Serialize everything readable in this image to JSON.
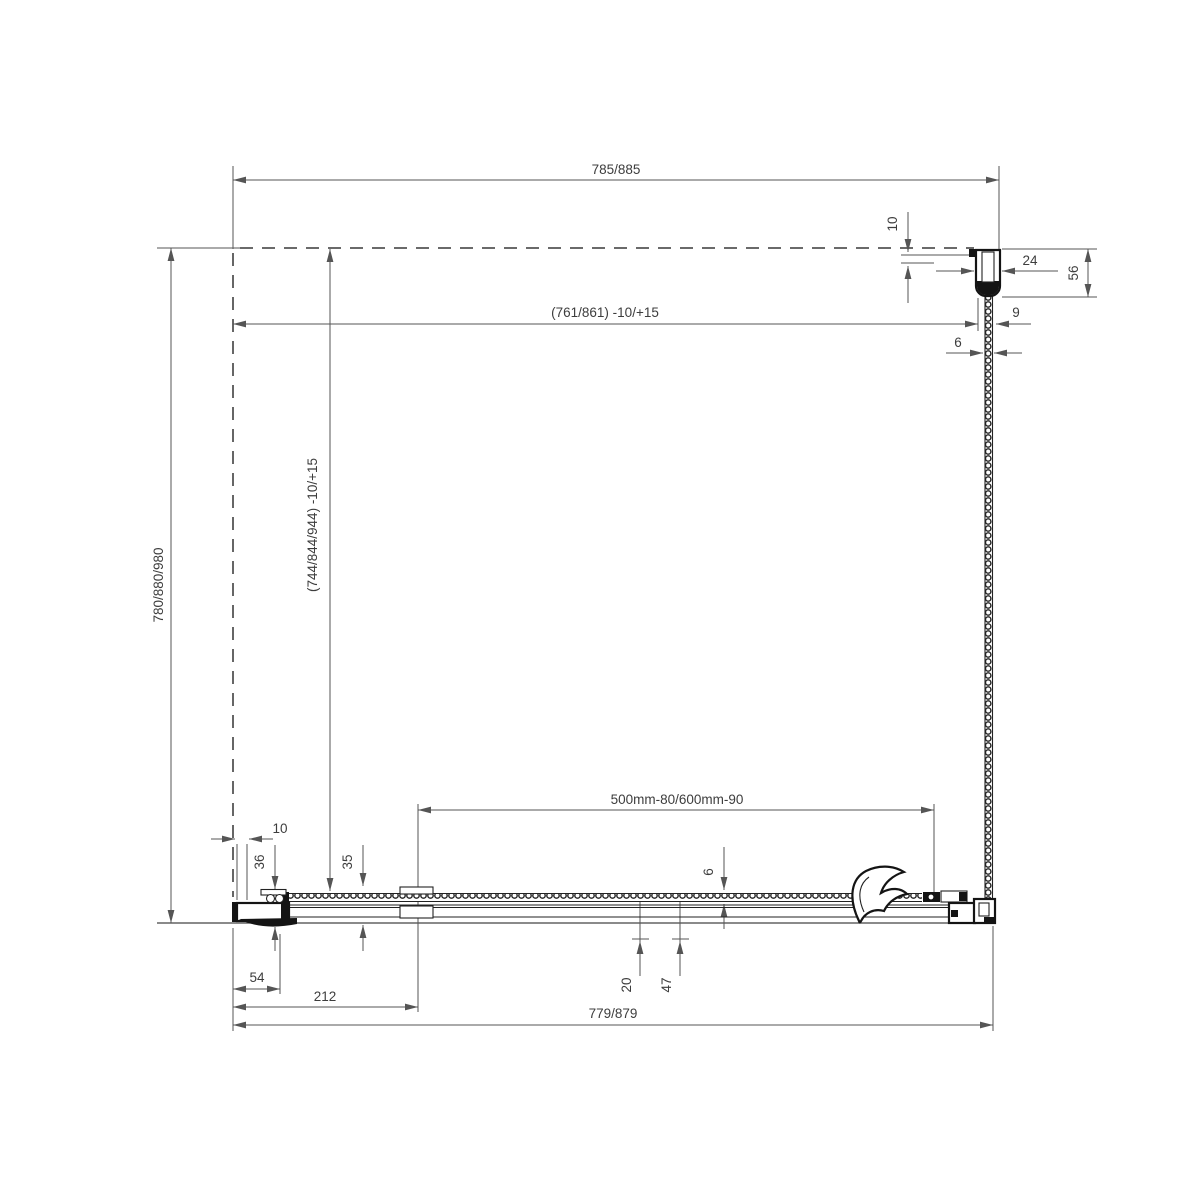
{
  "drawing": {
    "type": "technical-dimension-drawing",
    "subject": "shower-enclosure-plan-view",
    "colors": {
      "line": "#141414",
      "dimension": "#555555",
      "background": "#ffffff"
    },
    "dims": {
      "top_width": "785/885",
      "top_width_adjust": "(761/861) -10/+15",
      "side_depth": "780/880/980",
      "side_depth_adjust": "(744/844/944) -10/+15",
      "profile_offset": "10",
      "profile_width": "24",
      "profile_depth": "56",
      "glass_with_seals": "9",
      "panel_glass_thickness": "6",
      "entry_width": "500mm-80/600mm-90",
      "door_glass_thickness": "6",
      "dim_20": "20",
      "dim_47": "47",
      "wall_gap": "10",
      "dim_36": "36",
      "dim_35": "35",
      "dim_54": "54",
      "dim_212": "212",
      "bottom_width": "779/879"
    }
  }
}
